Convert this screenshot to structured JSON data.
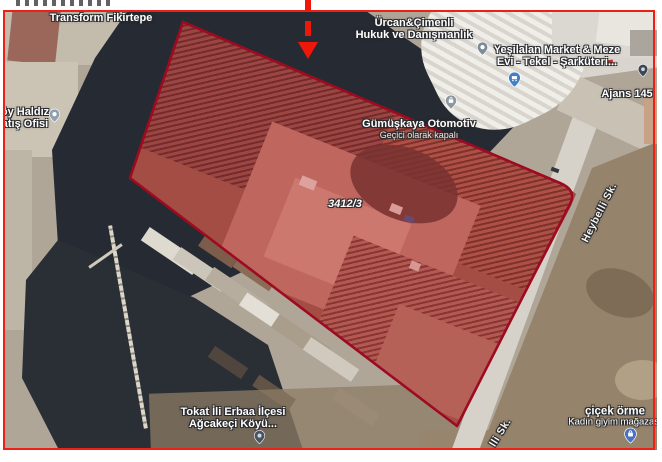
{
  "window": {
    "width": 662,
    "height": 456
  },
  "frame": {
    "color": "#ee2016"
  },
  "annotation": {
    "arrow_color": "#ee1708",
    "direction": "down"
  },
  "map": {
    "view": "satellite",
    "parcel": {
      "id": "3412/3",
      "outline_color": "#9e0b20",
      "fill": "rgba(198,38,50,0.32)"
    },
    "labels": {
      "transform_fikirtepe": {
        "text": "Transform Fikirtepe"
      },
      "haldiz": {
        "line1": "öy Haldız",
        "line2": "atış Ofisi"
      },
      "urcan": {
        "line1": "Ürcan&Çimenli",
        "line2": "Hukuk ve Danışmanlık"
      },
      "yesilalan": {
        "line1": "Yeşilalan Market & Meze",
        "line2": "Evi - Tekel - Şarküteri..."
      },
      "ajans": {
        "text": "Ajans 145"
      },
      "gumuskaya": {
        "name": "Gümüşkaya Otomotiv",
        "status": "Geçici olarak kapalı"
      },
      "heybelli_upper": {
        "text": "Heybelli Sk."
      },
      "heybelli_lower": {
        "text": "lli Sk."
      },
      "tokat": {
        "line1": "Tokat İli Erbaa İlçesi",
        "line2": "Ağcakeçi Köyü..."
      },
      "cicek": {
        "line1": "çiçek örme",
        "line2": "Kadın giyim mağazası"
      },
      "parcel_number": {
        "text": "3412/3"
      }
    },
    "pins": [
      {
        "name": "haldiz-pin",
        "style": "gray-dot",
        "color": "#8fa0ae"
      },
      {
        "name": "urcan-pin",
        "style": "gray-dot",
        "color": "#7d8a99"
      },
      {
        "name": "yesilalan-pin",
        "style": "blue-cart",
        "color": "#4180c4"
      },
      {
        "name": "ajans-pin",
        "style": "dark-dot",
        "color": "#3e4854"
      },
      {
        "name": "gumuskaya-pin",
        "style": "gray-bag",
        "color": "#8d979f"
      },
      {
        "name": "tokat-pin",
        "style": "dark-dot",
        "color": "#4a5560"
      },
      {
        "name": "cicek-pin",
        "style": "blue-bag",
        "color": "#4a71c4"
      }
    ]
  }
}
